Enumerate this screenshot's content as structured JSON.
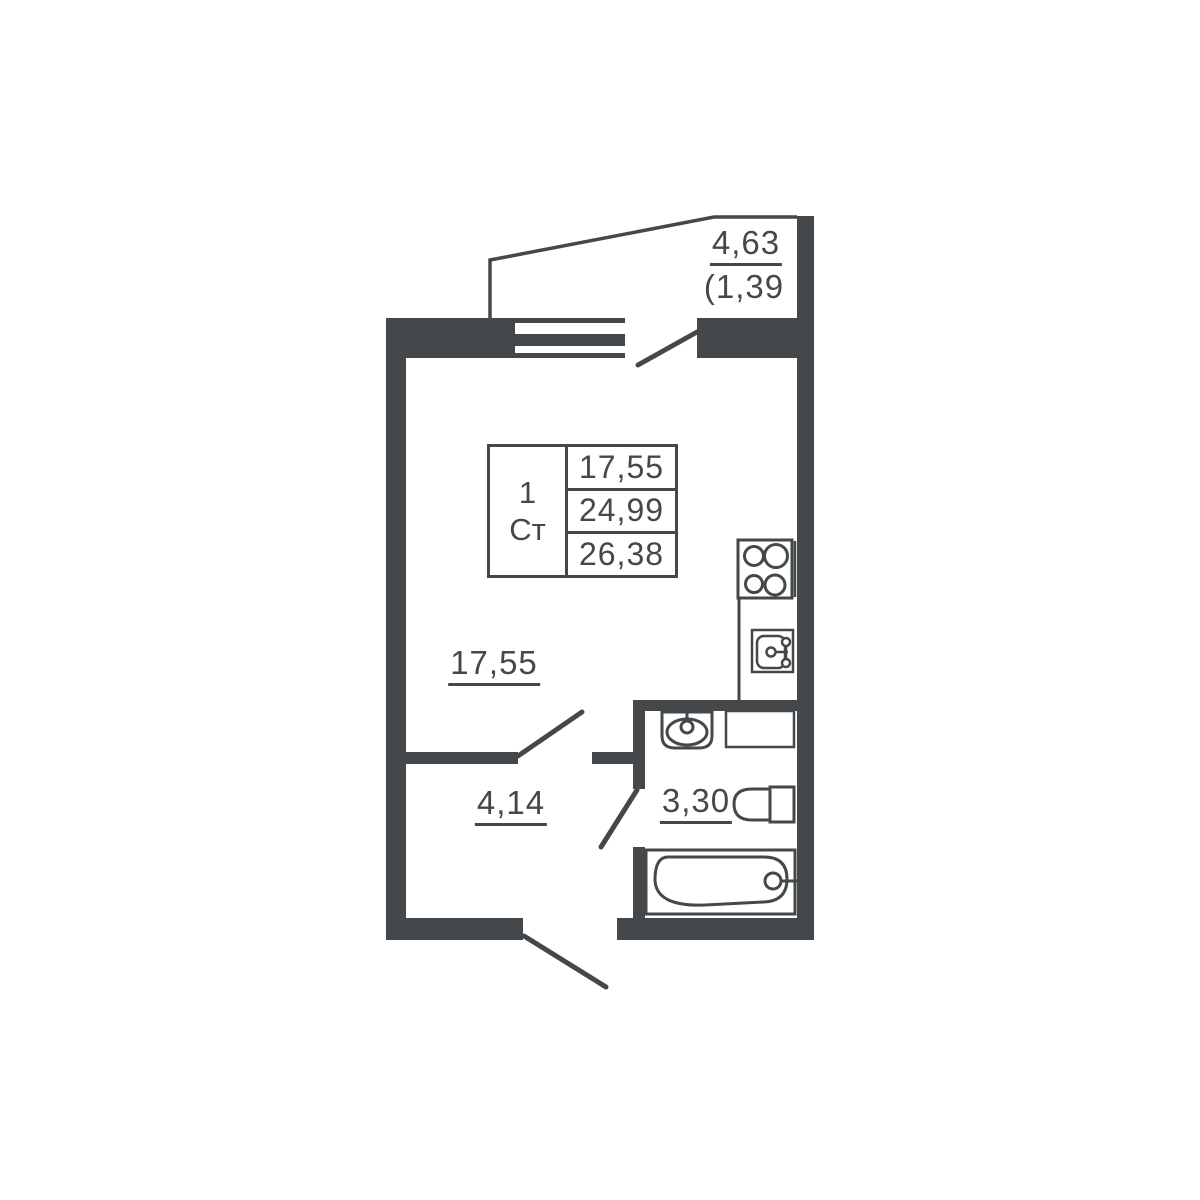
{
  "colors": {
    "wall": "#45484a",
    "background": "#ffffff"
  },
  "labels": {
    "balcony_area": "4,63",
    "balcony_reduced_area": "(1,39",
    "main_room_area": "17,55",
    "hallway_area": "4,14",
    "bathroom_area": "3,30"
  },
  "info_table": {
    "rooms_count": "1",
    "unit_type": "Ст",
    "living_area": "17,55",
    "area_without_balcony": "24,99",
    "total_area": "26,38"
  }
}
